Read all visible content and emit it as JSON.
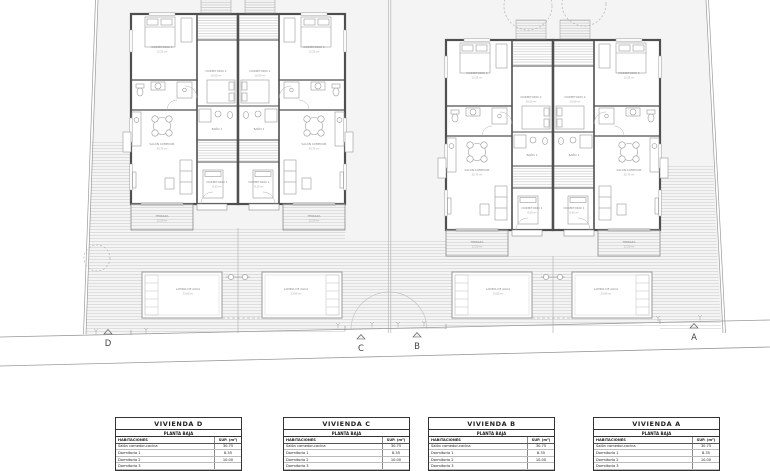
{
  "plan": {
    "rooms": {
      "dorm3_name": "DORMITORIO 3",
      "dorm3_area": "13.55 m²",
      "dorm2_name": "DORMITORIO 2",
      "dorm2_area": "10.00 m²",
      "bano1_name": "BAÑO 1",
      "salon_name": "SALÓN COMEDOR",
      "salon_area": "30.75 m²",
      "dorm1_name": "DORMITORIO 1",
      "dorm1_area": "8.35 m²",
      "terraza_name": "TERRAZA",
      "terraza_area": "12.50 m²",
      "pool_name": "LÁMINA DE AGUA",
      "pool_area": "23.60 m²"
    },
    "markers": [
      "D",
      "C",
      "B",
      "A"
    ]
  },
  "tables": [
    {
      "title": "VIVIENDA D",
      "subtitle": "PLANTA BAJA",
      "col_room": "HABITACIONES",
      "col_sup": "SUP. (m²)",
      "rows": [
        {
          "name": "Salón comedor-cocina",
          "sup": "30.75"
        },
        {
          "name": "Dormitorio 1",
          "sup": "8.35"
        },
        {
          "name": "Dormitorio 2",
          "sup": "10.00"
        },
        {
          "name": "Dormitorio 3",
          "sup": ""
        }
      ]
    },
    {
      "title": "VIVIENDA C",
      "subtitle": "PLANTA BAJA",
      "col_room": "HABITACIONES",
      "col_sup": "SUP. (m²)",
      "rows": [
        {
          "name": "Salón comedor-cocina",
          "sup": "30.75"
        },
        {
          "name": "Dormitorio 1",
          "sup": "8.35"
        },
        {
          "name": "Dormitorio 2",
          "sup": "10.00"
        },
        {
          "name": "Dormitorio 3",
          "sup": ""
        }
      ]
    },
    {
      "title": "VIVIENDA B",
      "subtitle": "PLANTA BAJA",
      "col_room": "HABITACIONES",
      "col_sup": "SUP. (m²)",
      "rows": [
        {
          "name": "Salón comedor-cocina",
          "sup": "30.75"
        },
        {
          "name": "Dormitorio 1",
          "sup": "8.35"
        },
        {
          "name": "Dormitorio 2",
          "sup": "10.00"
        },
        {
          "name": "Dormitorio 3",
          "sup": ""
        }
      ]
    },
    {
      "title": "VIVIENDA A",
      "subtitle": "PLANTA BAJA",
      "col_room": "HABITACIONES",
      "col_sup": "SUP. (m²)",
      "rows": [
        {
          "name": "Salón comedor-cocina",
          "sup": "30.75"
        },
        {
          "name": "Dormitorio 1",
          "sup": "8.35"
        },
        {
          "name": "Dormitorio 2",
          "sup": "10.00"
        },
        {
          "name": "Dormitorio 3",
          "sup": ""
        }
      ]
    }
  ]
}
